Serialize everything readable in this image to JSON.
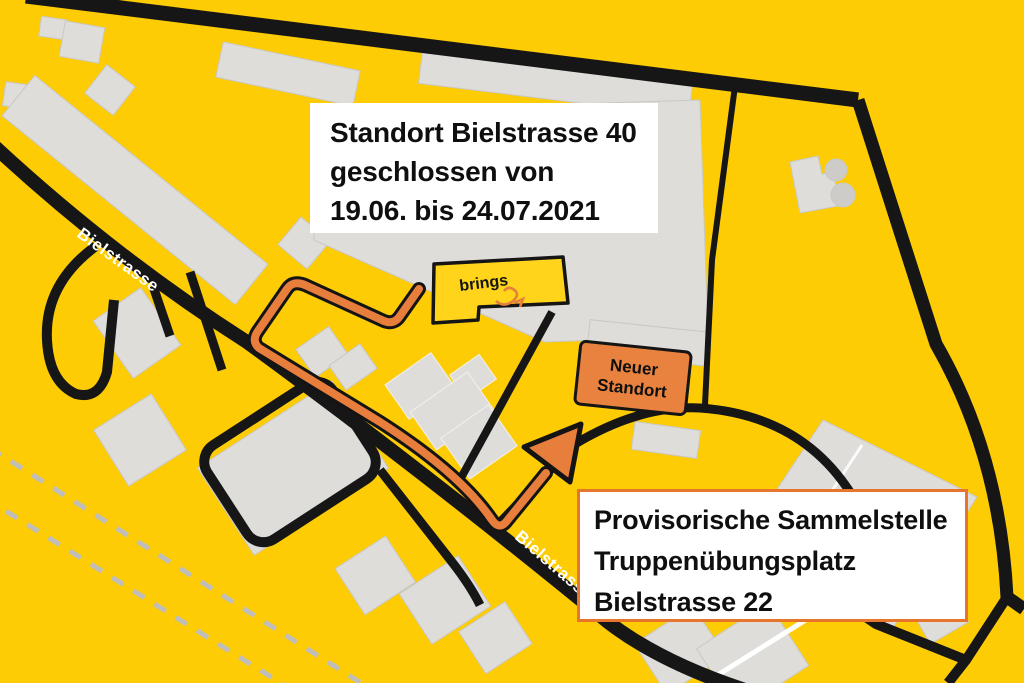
{
  "colors": {
    "background": "#FECC05",
    "road": "#161616",
    "building": "#DEDDDA",
    "building_outline": "#C9C8C5",
    "route_orange": "#E87E3C",
    "new_location_fill": "#E8823E",
    "provisional_border": "#E8752C",
    "railway": "#BFBEBB",
    "brings_fill": "#FFD41A"
  },
  "street_labels": {
    "top": "Bielstrasse",
    "bottom": "Bielstrasse"
  },
  "brings_building": {
    "label": "brings"
  },
  "callouts": {
    "closure": {
      "lines": [
        "Standort Bielstrasse 40",
        "geschlossen von",
        "19.06. bis 24.07.2021"
      ]
    },
    "new_location": {
      "lines": [
        "Neuer",
        "Standort"
      ]
    },
    "provisional": {
      "lines": [
        "Provisorische Sammelstelle",
        "Truppenübungsplatz",
        "Bielstrasse 22"
      ]
    }
  }
}
